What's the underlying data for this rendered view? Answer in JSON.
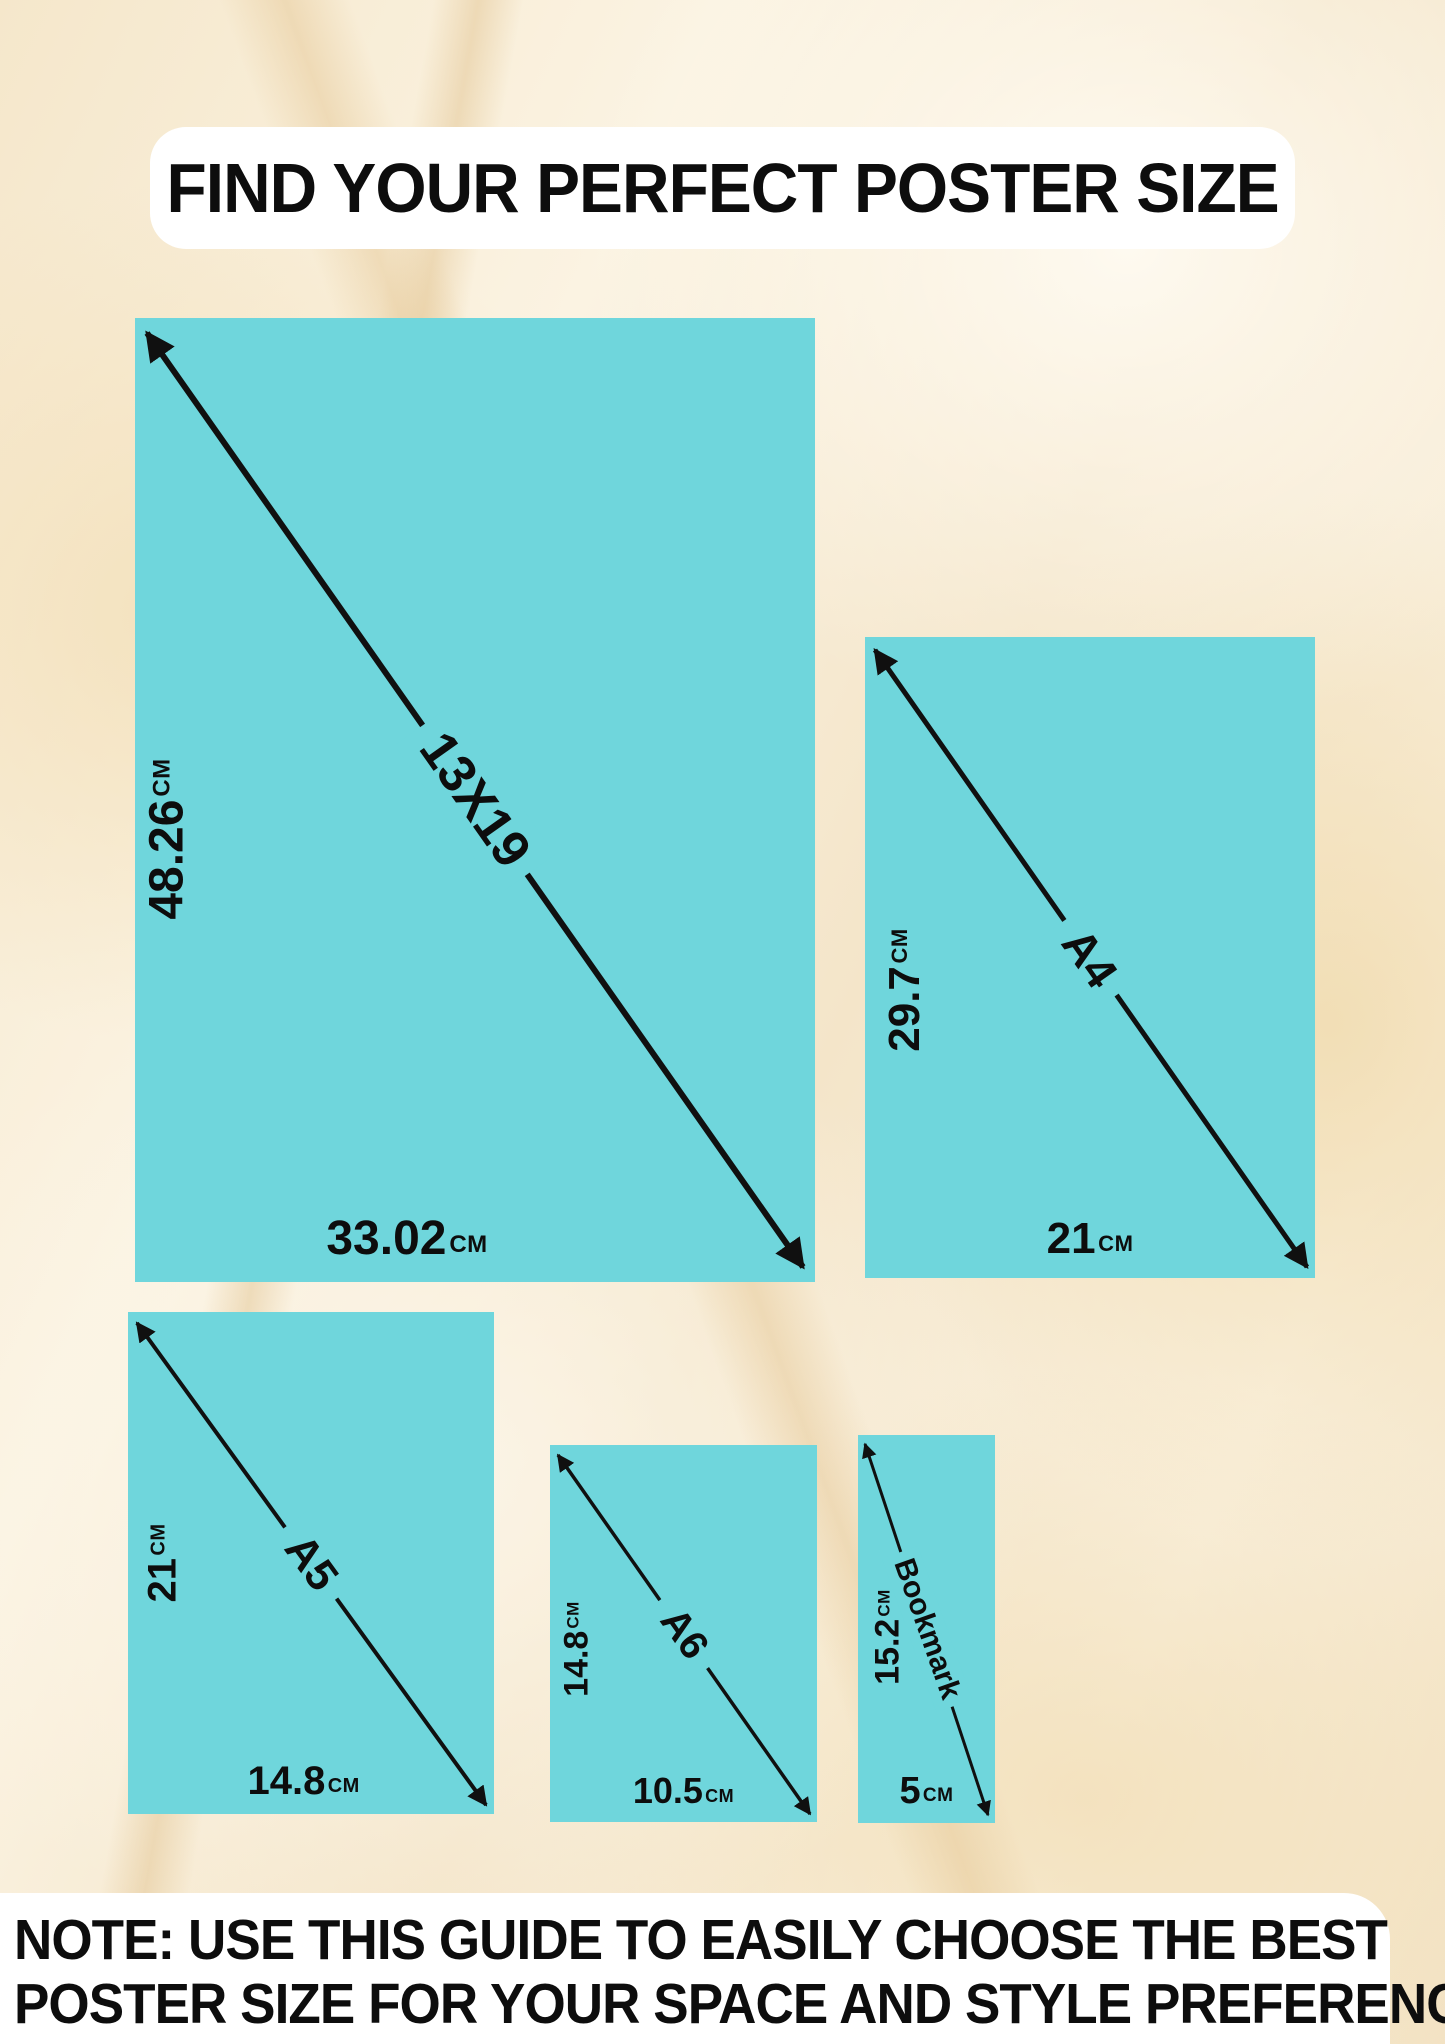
{
  "title": "FIND YOUR PERFECT POSTER SIZE",
  "note": {
    "line1": "NOTE: USE THIS GUIDE TO EASILY CHOOSE THE BEST",
    "line2": "POSTER SIZE FOR YOUR SPACE AND STYLE PREFERENCES"
  },
  "colors": {
    "poster_fill": "#6fd6dc",
    "ink": "#111111",
    "background_base": "#f8eedb",
    "panel": "#ffffff"
  },
  "posters": [
    {
      "name": "13X19",
      "height_value": "48.26",
      "height_unit": "CM",
      "width_value": "33.02",
      "width_unit": "CM"
    },
    {
      "name": "A4",
      "height_value": "29.7",
      "height_unit": "CM",
      "width_value": "21",
      "width_unit": "CM"
    },
    {
      "name": "A5",
      "height_value": "21",
      "height_unit": "CM",
      "width_value": "14.8",
      "width_unit": "CM"
    },
    {
      "name": "A6",
      "height_value": "14.8",
      "height_unit": "CM",
      "width_value": "10.5",
      "width_unit": "CM"
    },
    {
      "name": "Bookmark",
      "height_value": "15.2",
      "height_unit": "CM",
      "width_value": "5",
      "width_unit": "CM"
    }
  ]
}
